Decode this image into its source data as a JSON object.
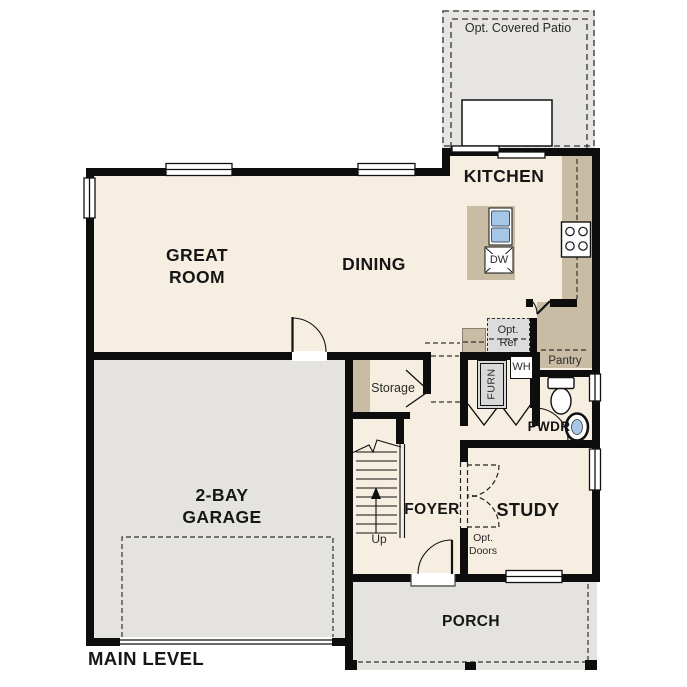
{
  "plan": {
    "title": "MAIN LEVEL",
    "rooms": {
      "patio": "Opt. Covered Patio",
      "kitchen": "KITCHEN",
      "great_room": "GREAT ROOM",
      "dining": "DINING",
      "garage": "2-BAY GARAGE",
      "study": "STUDY",
      "foyer": "FOYER",
      "porch": "PORCH",
      "storage": "Storage",
      "pantry": "Pantry",
      "powder": "PWDR"
    },
    "annotations": {
      "up": "Up",
      "opt_doors": "Opt. Doors",
      "opt_ref": "Opt. Ref",
      "water_heater": "WH",
      "furnace": "FURN",
      "dishwasher": "DW"
    },
    "colors": {
      "floor_cream": "#f6eee1",
      "exterior_gray": "#e4e3e0",
      "cabinet_tan": "#c9bca5",
      "wall_black": "#0d0d0d",
      "fixture_blue": "#a5c6e6",
      "optional_gray": "#dcdcdc"
    }
  }
}
